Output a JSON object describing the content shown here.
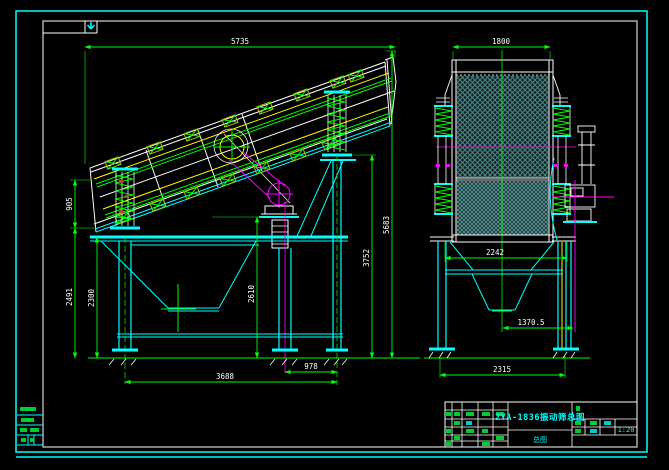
{
  "drawing": {
    "type": "CAD assembly drawing, vibrating screen, two orthographic views",
    "colors": {
      "background": "#000000",
      "outer_border": "#00ffff",
      "inner_frame": "#ffffff",
      "dimension_line": "#00ff00",
      "dimension_text": "#ffffff",
      "structure": "#00ffff",
      "deck_line": "#ffff00",
      "centerline": "#ff00ff",
      "mesh": "#4d8585",
      "title_text": "#00ffff"
    },
    "side_view": {
      "dims": {
        "overall_length": "5735",
        "spring_height": "905",
        "left_height": "2491",
        "leg_height": "2300",
        "mid_height": "2610",
        "rear_height": "3752",
        "overall_height": "5683",
        "rear_span": "978",
        "support_span": "3688"
      }
    },
    "front_view": {
      "dims": {
        "width": "1800",
        "spring_span": "2242",
        "motor_offset": "1370.5",
        "base_span": "2315"
      }
    },
    "title_block": {
      "title": "2YA-1836振动筛总图",
      "sub_label": "总图",
      "scale": "1:20"
    }
  }
}
